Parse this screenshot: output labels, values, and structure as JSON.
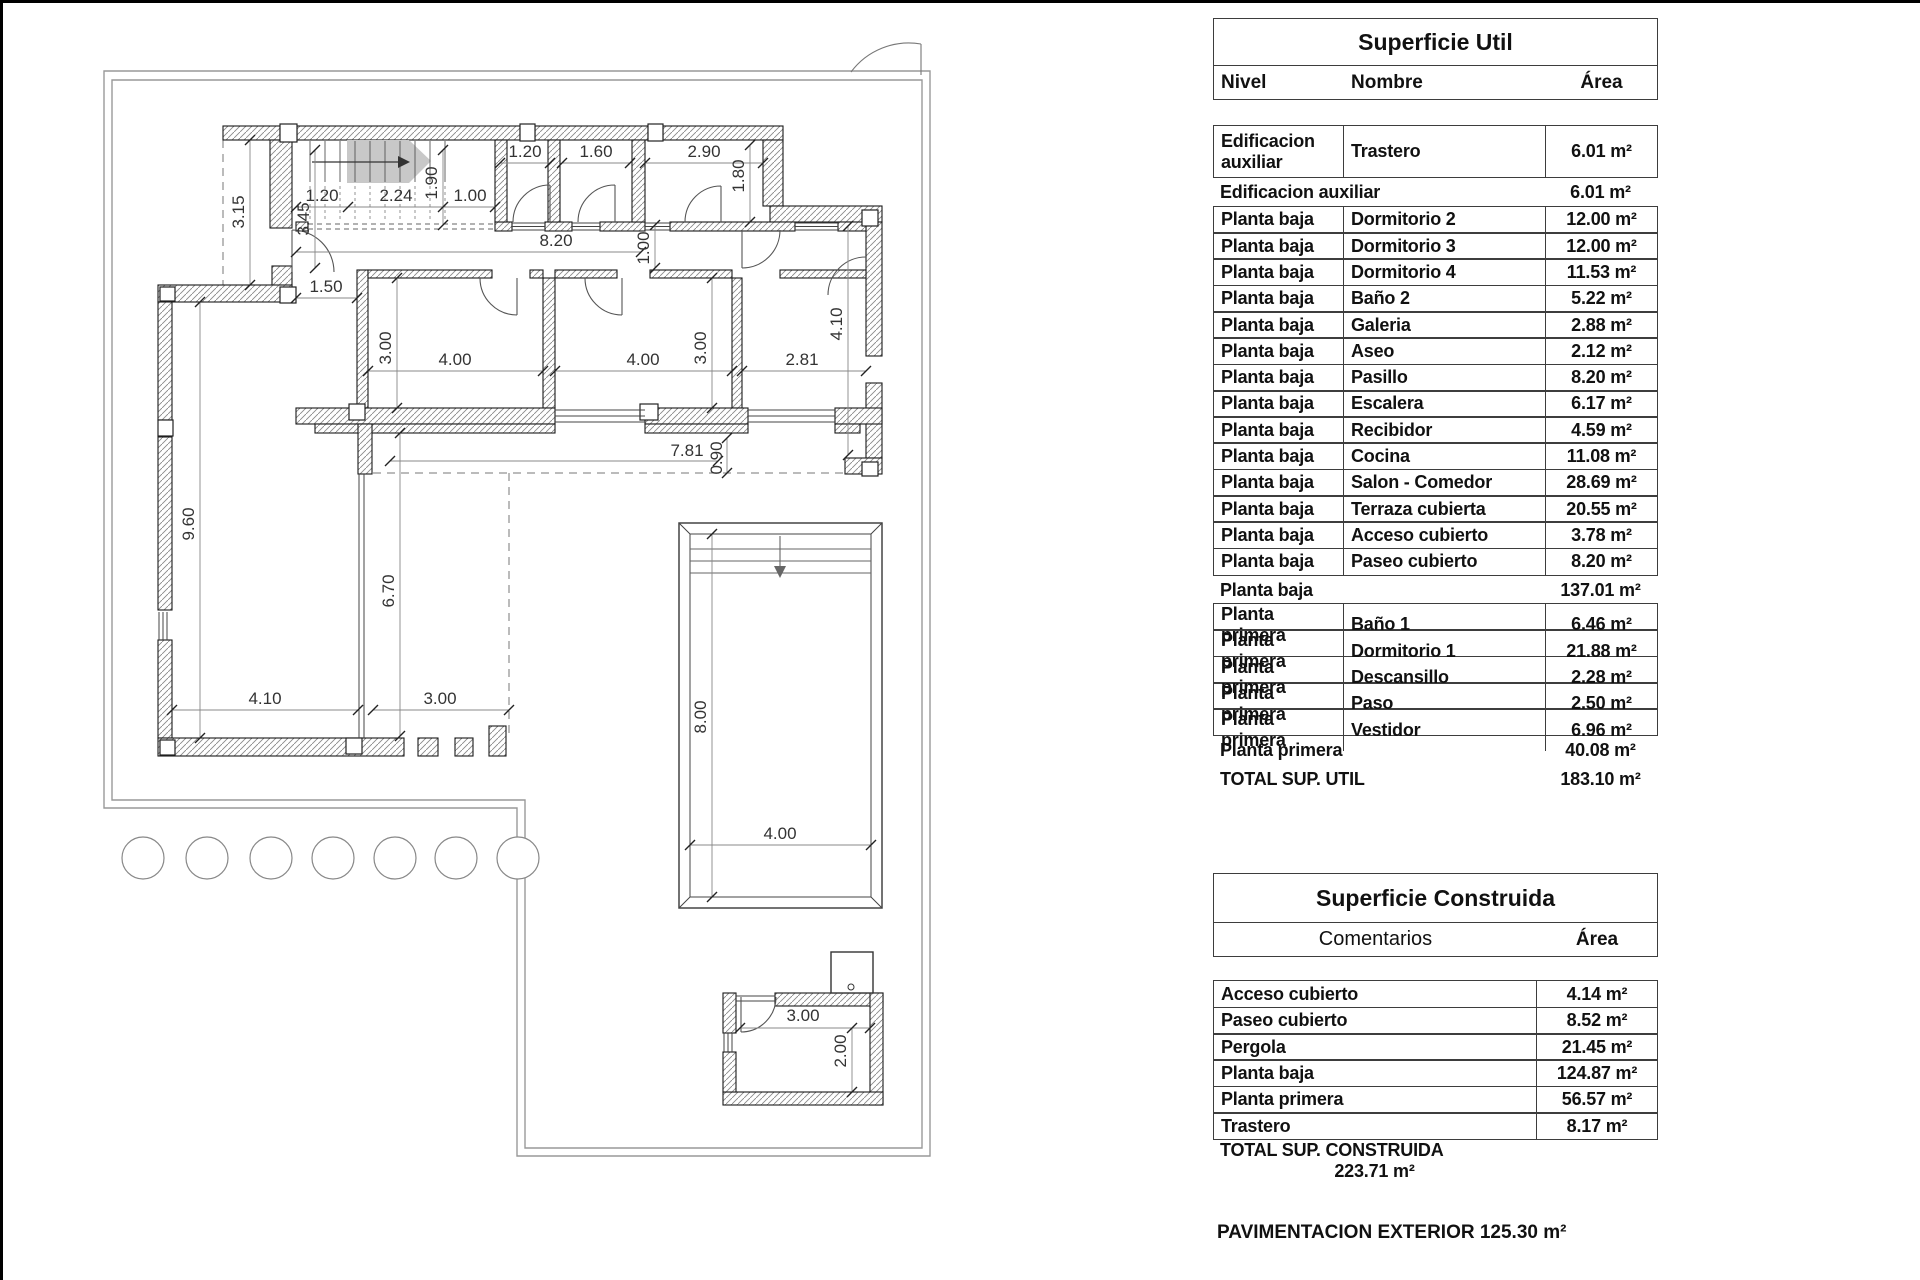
{
  "plan": {
    "name": "floor-plan",
    "dimensions": [
      {
        "t": "3.15",
        "x": 244,
        "y": 212,
        "r": -90
      },
      {
        "t": "3.45",
        "x": 309,
        "y": 219,
        "r": -90
      },
      {
        "t": "1.20",
        "x": 322,
        "y": 201
      },
      {
        "t": "2.24",
        "x": 396,
        "y": 201
      },
      {
        "t": "1.90",
        "x": 437,
        "y": 183,
        "r": -90
      },
      {
        "t": "1.00",
        "x": 470,
        "y": 201
      },
      {
        "t": "1.20",
        "x": 525,
        "y": 157
      },
      {
        "t": "1.60",
        "x": 596,
        "y": 157
      },
      {
        "t": "2.90",
        "x": 704,
        "y": 157
      },
      {
        "t": "1.80",
        "x": 744,
        "y": 176,
        "r": -90
      },
      {
        "t": "8.20",
        "x": 556,
        "y": 246
      },
      {
        "t": "1.00",
        "x": 649,
        "y": 248,
        "r": -90
      },
      {
        "t": "1.50",
        "x": 326,
        "y": 292
      },
      {
        "t": "3.00",
        "x": 391,
        "y": 348,
        "r": -90
      },
      {
        "t": "4.00",
        "x": 455,
        "y": 365
      },
      {
        "t": "4.00",
        "x": 643,
        "y": 365
      },
      {
        "t": "3.00",
        "x": 706,
        "y": 348,
        "r": -90
      },
      {
        "t": "2.81",
        "x": 802,
        "y": 365
      },
      {
        "t": "4.10",
        "x": 842,
        "y": 324,
        "r": -90
      },
      {
        "t": "9.60",
        "x": 194,
        "y": 524,
        "r": -90
      },
      {
        "t": "6.70",
        "x": 394,
        "y": 591,
        "r": -90
      },
      {
        "t": "4.10",
        "x": 265,
        "y": 704
      },
      {
        "t": "3.00",
        "x": 440,
        "y": 704
      },
      {
        "t": "7.81",
        "x": 687,
        "y": 456
      },
      {
        "t": "0.90",
        "x": 722,
        "y": 458,
        "r": -90
      },
      {
        "t": "8.00",
        "x": 706,
        "y": 717,
        "r": -90
      },
      {
        "t": "4.00",
        "x": 780,
        "y": 839
      },
      {
        "t": "3.00",
        "x": 803,
        "y": 1021
      },
      {
        "t": "2.00",
        "x": 846,
        "y": 1051,
        "r": -90
      }
    ]
  },
  "tables": {
    "util": {
      "title": "Superficie Util",
      "headers": {
        "nivel": "Nivel",
        "nombre": "Nombre",
        "area": "Área"
      },
      "rows": [
        {
          "type": "data2",
          "nivel": "Edificacion auxiliar",
          "nombre": "Trastero",
          "area": "6.01 m²"
        },
        {
          "type": "subtotal",
          "nivel": "Edificacion auxiliar",
          "nombre": "",
          "area": "6.01 m²"
        },
        {
          "type": "data",
          "nivel": "Planta baja",
          "nombre": "Dormitorio 2",
          "area": "12.00 m²"
        },
        {
          "type": "data",
          "nivel": "Planta baja",
          "nombre": "Dormitorio 3",
          "area": "12.00 m²"
        },
        {
          "type": "data",
          "nivel": "Planta baja",
          "nombre": "Dormitorio 4",
          "area": "11.53 m²"
        },
        {
          "type": "data",
          "nivel": "Planta baja",
          "nombre": "Baño 2",
          "area": "5.22 m²"
        },
        {
          "type": "data",
          "nivel": "Planta baja",
          "nombre": "Galeria",
          "area": "2.88 m²"
        },
        {
          "type": "data",
          "nivel": "Planta baja",
          "nombre": "Aseo",
          "area": "2.12 m²"
        },
        {
          "type": "data",
          "nivel": "Planta baja",
          "nombre": "Pasillo",
          "area": "8.20 m²"
        },
        {
          "type": "data",
          "nivel": "Planta baja",
          "nombre": "Escalera",
          "area": "6.17 m²"
        },
        {
          "type": "data",
          "nivel": "Planta baja",
          "nombre": "Recibidor",
          "area": "4.59 m²"
        },
        {
          "type": "data",
          "nivel": "Planta baja",
          "nombre": "Cocina",
          "area": "11.08 m²"
        },
        {
          "type": "data",
          "nivel": "Planta baja",
          "nombre": "Salon - Comedor",
          "area": "28.69 m²"
        },
        {
          "type": "data",
          "nivel": "Planta baja",
          "nombre": "Terraza cubierta",
          "area": "20.55 m²"
        },
        {
          "type": "data",
          "nivel": "Planta baja",
          "nombre": "Acceso cubierto",
          "area": "3.78 m²"
        },
        {
          "type": "data",
          "nivel": "Planta baja",
          "nombre": "Paseo cubierto",
          "area": "8.20 m²"
        },
        {
          "type": "subtotal",
          "nivel": "Planta baja",
          "nombre": "",
          "area": "137.01 m²"
        },
        {
          "type": "data",
          "nivel": "Planta primera",
          "nombre": "Baño 1",
          "area": "6.46 m²"
        },
        {
          "type": "data",
          "nivel": "Planta primera",
          "nombre": "Dormitorio 1",
          "area": "21.88 m²"
        },
        {
          "type": "data",
          "nivel": "Planta primera",
          "nombre": "Descansillo",
          "area": "2.28 m²"
        },
        {
          "type": "data",
          "nivel": "Planta primera",
          "nombre": "Paso",
          "area": "2.50 m²"
        },
        {
          "type": "data",
          "nivel": "Planta primera",
          "nombre": "Vestidor",
          "area": "6.96 m²"
        },
        {
          "type": "subtotal",
          "nivel": "Planta primera",
          "nombre": "",
          "area": "40.08 m²"
        },
        {
          "type": "total",
          "nivel": "TOTAL SUP. UTIL",
          "nombre": "",
          "area": "183.10 m²"
        }
      ]
    },
    "construida": {
      "title": "Superficie Construida",
      "headers": {
        "comentarios": "Comentarios",
        "area": "Área"
      },
      "rows": [
        {
          "type": "data",
          "nombre": "Acceso cubierto",
          "area": "4.14 m²"
        },
        {
          "type": "data",
          "nombre": "Paseo cubierto",
          "area": "8.52 m²"
        },
        {
          "type": "data",
          "nombre": "Pergola",
          "area": "21.45 m²"
        },
        {
          "type": "data",
          "nombre": "Planta baja",
          "area": "124.87 m²"
        },
        {
          "type": "data",
          "nombre": "Planta primera",
          "area": "56.57 m²"
        },
        {
          "type": "data",
          "nombre": "Trastero",
          "area": "8.17 m²"
        },
        {
          "type": "total",
          "nombre": "TOTAL SUP. CONSTRUIDA",
          "area": "223.71 m²"
        }
      ]
    },
    "footnote": "PAVIMENTACION EXTERIOR 125.30 m²"
  }
}
